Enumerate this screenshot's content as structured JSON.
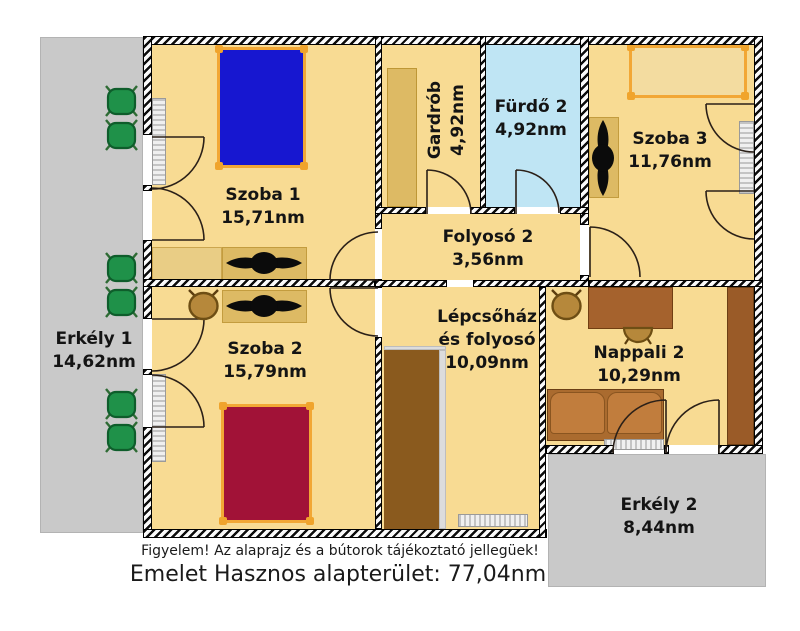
{
  "rooms": {
    "szoba1": {
      "name": "Szoba 1",
      "area": "15,71nm"
    },
    "szoba2": {
      "name": "Szoba 2",
      "area": "15,79nm"
    },
    "szoba3": {
      "name": "Szoba 3",
      "area": "11,76nm"
    },
    "gardrob": {
      "name": "Gardrób",
      "area": "4,92nm"
    },
    "furdo2": {
      "name": "Fürdő 2",
      "area": "4,92nm"
    },
    "folyoso2": {
      "name": "Folyosó 2",
      "area": "3,56nm"
    },
    "lepcsohaz": {
      "name_line1": "Lépcsőház",
      "name_line2": "és folyosó",
      "area": "10,09nm"
    },
    "nappali2": {
      "name": "Nappali 2",
      "area": "10,29nm"
    },
    "erkely1": {
      "name": "Erkély 1",
      "area": "14,62nm"
    },
    "erkely2": {
      "name": "Erkély 2",
      "area": "8,44nm"
    }
  },
  "footer": {
    "disclaimer": "Figyelem! Az alaprajz és a bútorok tájékoztató jellegüek!",
    "total": "Emelet Hasznos alapterület: 77,04nm"
  },
  "icons": {
    "ceiling_fan": "propeller-fan-icon",
    "door": "door-swing-arc",
    "radiator": "striped-radiator",
    "garden_chair": "green-chair-icon",
    "desk_chair": "tan-chair-icon"
  },
  "colors": {
    "floor": "#f8db93",
    "bathroom_floor": "#bfe5f4",
    "balcony": "#c9c9c9",
    "bed_blue": "#1717d0",
    "bed_red": "#a11237",
    "bed_frame_orange": "#f2a735",
    "furniture_tan": "#ddba64",
    "stairs_brown": "#8a5a1e",
    "sofa_brown": "#c17d3d",
    "chair_green": "#1f9149",
    "text": "#141414"
  }
}
